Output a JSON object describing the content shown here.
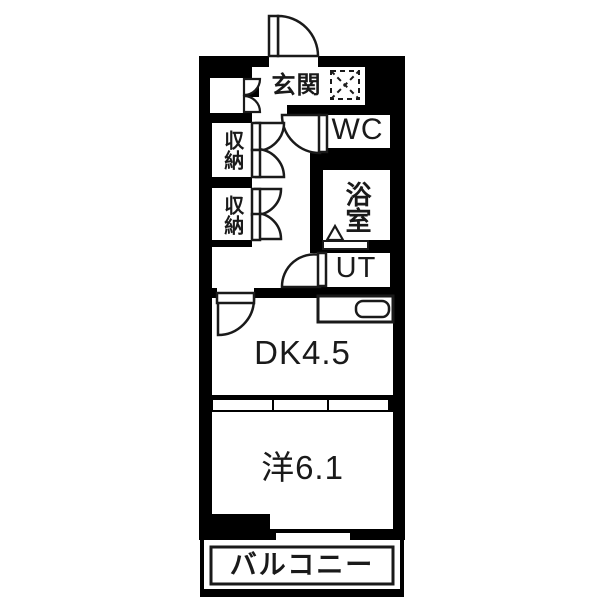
{
  "plan": {
    "type": "apartment-floorplan",
    "rooms": {
      "genkan": "玄関",
      "wc": "WC",
      "bath": "浴室",
      "utility": "UT",
      "storage_upper": "収納",
      "storage_lower": "収納",
      "dining_kitchen": "DK4.5",
      "western_room": "洋6.1",
      "balcony": "バルコニー"
    },
    "colors": {
      "wall": "#000000",
      "floor": "#ffffff",
      "line": "#1a1a1a"
    }
  }
}
